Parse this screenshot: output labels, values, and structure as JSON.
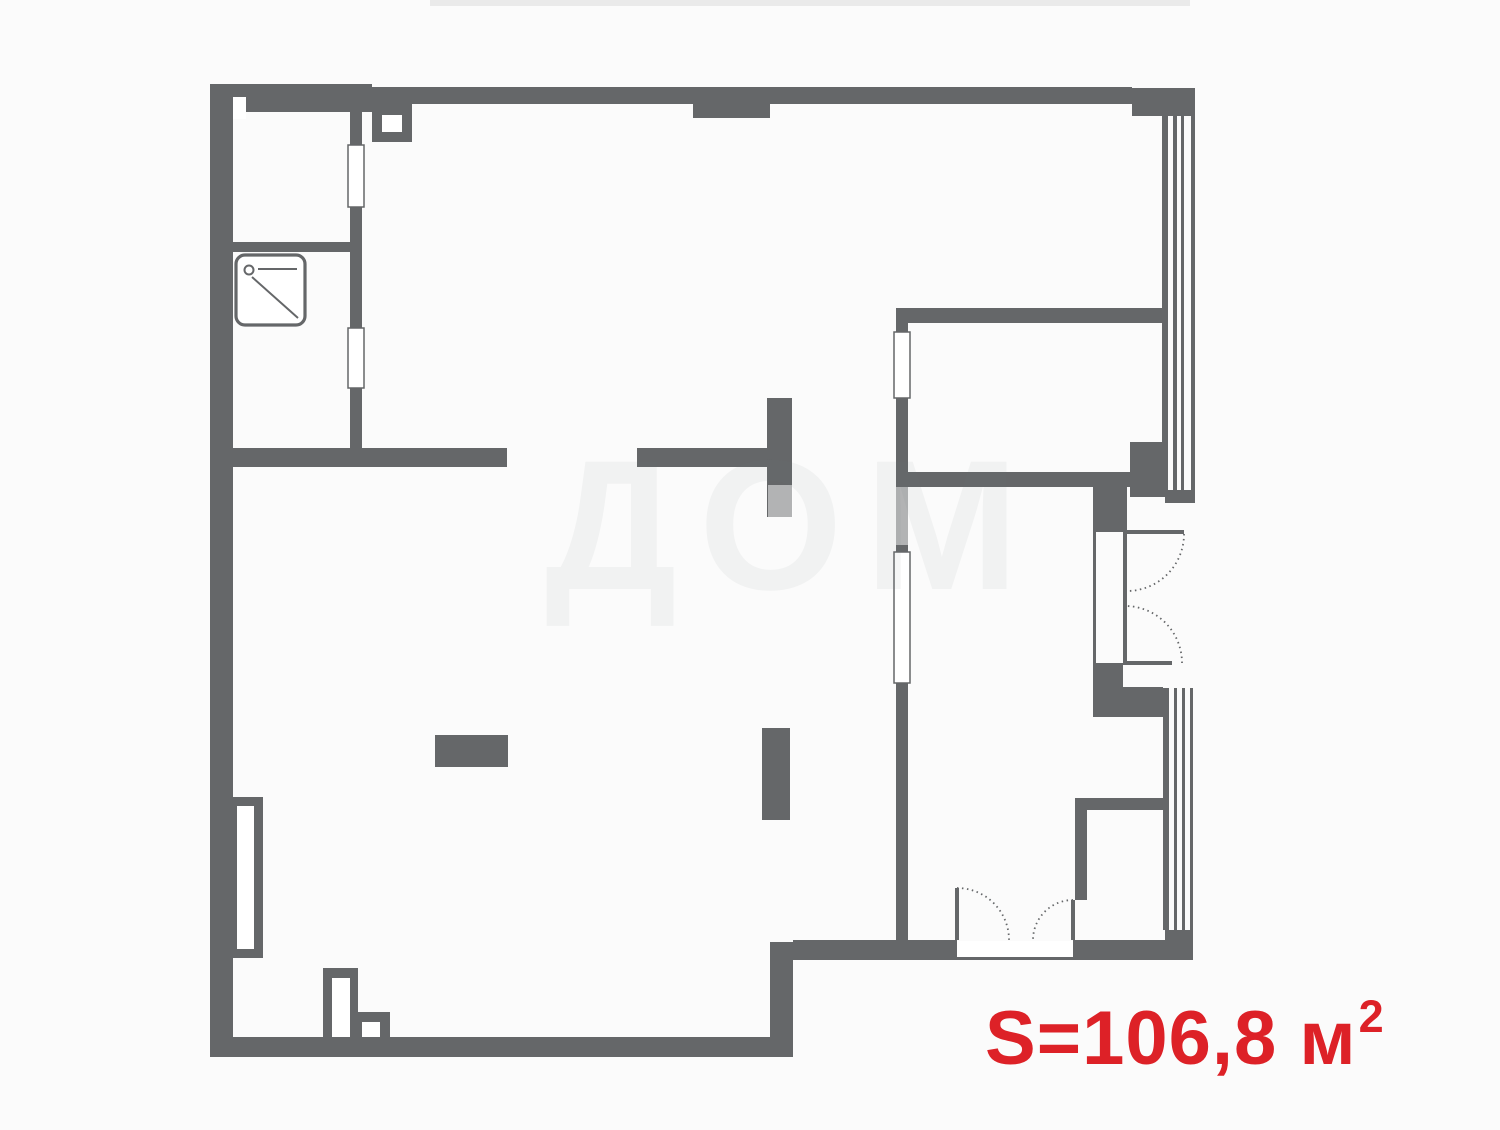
{
  "canvas": {
    "width": 1500,
    "height": 1130,
    "background": "#fbfbfb"
  },
  "colors": {
    "wall": "#656769",
    "accent_red": "#dd2127",
    "watermark": "rgba(120,125,130,0.07)",
    "overlay": "rgba(255,255,255,0.5)"
  },
  "watermark_text": "ДОМ",
  "area_label": {
    "prefix": "S=106,8 м",
    "sup": "2"
  },
  "plan": {
    "walls": [
      {
        "name": "outer-wall-left",
        "x": 210,
        "y": 84,
        "w": 23,
        "h": 973
      },
      {
        "name": "outer-wall-top-thick",
        "x": 210,
        "y": 84,
        "w": 162,
        "h": 28
      },
      {
        "name": "outer-wall-top",
        "x": 372,
        "y": 87,
        "w": 760,
        "h": 17
      },
      {
        "name": "outer-wall-top-right-corner",
        "x": 1132,
        "y": 88,
        "w": 63,
        "h": 28
      },
      {
        "name": "duct-block",
        "x": 372,
        "y": 104,
        "w": 40,
        "h": 38
      },
      {
        "name": "top-wall-pier",
        "x": 693,
        "y": 104,
        "w": 77,
        "h": 14
      },
      {
        "name": "closet-right-wall",
        "x": 350,
        "y": 104,
        "w": 12,
        "h": 344
      },
      {
        "name": "closet-shower-divider-wall",
        "x": 233,
        "y": 242,
        "w": 117,
        "h": 10
      },
      {
        "name": "shower-room-bottom-wall",
        "x": 233,
        "y": 448,
        "w": 274,
        "h": 19
      },
      {
        "name": "hall-wall-segment",
        "x": 637,
        "y": 448,
        "w": 131,
        "h": 19
      },
      {
        "name": "hall-wall-stub",
        "x": 767,
        "y": 398,
        "w": 25,
        "h": 119
      },
      {
        "name": "central-wall",
        "x": 896,
        "y": 308,
        "w": 12,
        "h": 632
      },
      {
        "name": "bedroom-bottom-wall",
        "x": 896,
        "y": 308,
        "w": 269,
        "h": 15
      },
      {
        "name": "right-room-top-wall",
        "x": 896,
        "y": 472,
        "w": 267,
        "h": 15
      },
      {
        "name": "balcony-jamb-upper",
        "x": 1093,
        "y": 487,
        "w": 34,
        "h": 45
      },
      {
        "name": "balcony-jamb-lower",
        "x": 1093,
        "y": 663,
        "w": 30,
        "h": 54
      },
      {
        "name": "balcony-jamb-lower-2",
        "x": 1123,
        "y": 687,
        "w": 40,
        "h": 30
      },
      {
        "name": "closet2-top-wall",
        "x": 1075,
        "y": 798,
        "w": 90,
        "h": 12
      },
      {
        "name": "closet2-left-wall",
        "x": 1075,
        "y": 798,
        "w": 12,
        "h": 102
      },
      {
        "name": "bottom-right-wall-left",
        "x": 793,
        "y": 940,
        "w": 164,
        "h": 20
      },
      {
        "name": "bottom-right-wall-right",
        "x": 1073,
        "y": 940,
        "w": 120,
        "h": 20
      },
      {
        "name": "bottom-step-wall",
        "x": 770,
        "y": 942,
        "w": 23,
        "h": 115
      },
      {
        "name": "outer-wall-bottom",
        "x": 210,
        "y": 1037,
        "w": 583,
        "h": 20
      },
      {
        "name": "window-band-bottom-cap",
        "x": 1165,
        "y": 930,
        "w": 28,
        "h": 30
      },
      {
        "name": "window-pier-right",
        "x": 1130,
        "y": 442,
        "w": 35,
        "h": 55
      },
      {
        "name": "window-top-band-cap",
        "x": 1165,
        "y": 490,
        "w": 30,
        "h": 13
      },
      {
        "name": "kitchen-unit",
        "x": 435,
        "y": 735,
        "w": 73,
        "h": 32
      },
      {
        "name": "room-divider-stub",
        "x": 762,
        "y": 728,
        "w": 28,
        "h": 92
      },
      {
        "name": "wall-niche-left-frame",
        "x": 228,
        "y": 797,
        "w": 35,
        "h": 161
      },
      {
        "name": "wall-niche-bottom-frame",
        "x": 323,
        "y": 968,
        "w": 35,
        "h": 69
      },
      {
        "name": "wall-niche-bottom2-frame",
        "x": 358,
        "y": 1012,
        "w": 32,
        "h": 25
      },
      {
        "name": "window-glazing-line",
        "x": 1162,
        "y": 115,
        "w": 6,
        "h": 375
      },
      {
        "name": "window-glazing-line",
        "x": 1173,
        "y": 115,
        "w": 4,
        "h": 375
      },
      {
        "name": "window-glazing-line",
        "x": 1181,
        "y": 115,
        "w": 3,
        "h": 375
      },
      {
        "name": "window-glazing-line",
        "x": 1191,
        "y": 115,
        "w": 4,
        "h": 375
      },
      {
        "name": "window-glazing-line",
        "x": 1163,
        "y": 688,
        "w": 6,
        "h": 242
      },
      {
        "name": "window-glazing-line",
        "x": 1174,
        "y": 688,
        "w": 3,
        "h": 242
      },
      {
        "name": "window-glazing-line",
        "x": 1182,
        "y": 688,
        "w": 3,
        "h": 242
      },
      {
        "name": "window-glazing-line",
        "x": 1190,
        "y": 688,
        "w": 3,
        "h": 242
      },
      {
        "name": "balcony-door-frame-outer",
        "x": 1093,
        "y": 532,
        "w": 3,
        "h": 131
      },
      {
        "name": "balcony-door-frame-inner",
        "x": 1123,
        "y": 532,
        "w": 4,
        "h": 131
      },
      {
        "name": "balcony-door-leaf-top",
        "x": 1127,
        "y": 530,
        "w": 57,
        "h": 4
      },
      {
        "name": "balcony-door-leaf-bottom",
        "x": 1123,
        "y": 661,
        "w": 49,
        "h": 4
      },
      {
        "name": "terrace-door-leaf-left",
        "x": 955,
        "y": 888,
        "w": 4,
        "h": 52
      },
      {
        "name": "terrace-door-leaf-right",
        "x": 1071,
        "y": 900,
        "w": 4,
        "h": 40
      },
      {
        "name": "terrace-door-sill-line",
        "x": 957,
        "y": 957,
        "w": 116,
        "h": 3
      }
    ],
    "white_rects": [
      {
        "name": "wall-notch",
        "x": 233,
        "y": 97,
        "w": 13,
        "h": 22,
        "outline": false
      },
      {
        "name": "duct-opening",
        "x": 382,
        "y": 115,
        "w": 20,
        "h": 17,
        "outline": false
      },
      {
        "name": "door-opening",
        "x": 348,
        "y": 145,
        "w": 16,
        "h": 62,
        "outline": true
      },
      {
        "name": "door-opening",
        "x": 348,
        "y": 328,
        "w": 16,
        "h": 60,
        "outline": true
      },
      {
        "name": "window-opening",
        "x": 894,
        "y": 332,
        "w": 16,
        "h": 66,
        "outline": true
      },
      {
        "name": "door-opening",
        "x": 894,
        "y": 552,
        "w": 16,
        "h": 131,
        "outline": true
      },
      {
        "name": "terrace-door-threshold",
        "x": 957,
        "y": 941,
        "w": 116,
        "h": 16,
        "outline": false
      },
      {
        "name": "niche-inner",
        "x": 237,
        "y": 806,
        "w": 17,
        "h": 143,
        "outline": false
      },
      {
        "name": "niche-inner",
        "x": 332,
        "y": 978,
        "w": 18,
        "h": 59,
        "outline": false
      },
      {
        "name": "niche-inner",
        "x": 362,
        "y": 1022,
        "w": 18,
        "h": 15,
        "outline": false
      }
    ],
    "overlays": [
      {
        "name": "watermark-overlay",
        "x": 768,
        "y": 485,
        "w": 25,
        "h": 32
      },
      {
        "name": "watermark-overlay",
        "x": 896,
        "y": 487,
        "w": 12,
        "h": 58
      }
    ],
    "arcs": [
      {
        "name": "door-swing-arc",
        "d": "M 1184 534 A 57 57 0 0 1 1127 591"
      },
      {
        "name": "door-swing-arc",
        "d": "M 1182 663 A 57 57 0 0 0 1125 606"
      },
      {
        "name": "door-swing-arc",
        "d": "M 957 888 A 52 52 0 0 1 1009 940"
      },
      {
        "name": "door-swing-arc",
        "d": "M 1073 900 A 40 40 0 0 0 1033 940"
      }
    ],
    "shower": {
      "tray": {
        "x": 236,
        "y": 255,
        "w": 69,
        "h": 70,
        "rx": 9
      },
      "head_circle": {
        "cx": 249,
        "cy": 270,
        "r": 4.5
      },
      "lines": [
        {
          "x1": 258,
          "y1": 269,
          "x2": 297,
          "y2": 269
        },
        {
          "x1": 252,
          "y1": 277,
          "x2": 298,
          "y2": 318
        }
      ]
    }
  }
}
